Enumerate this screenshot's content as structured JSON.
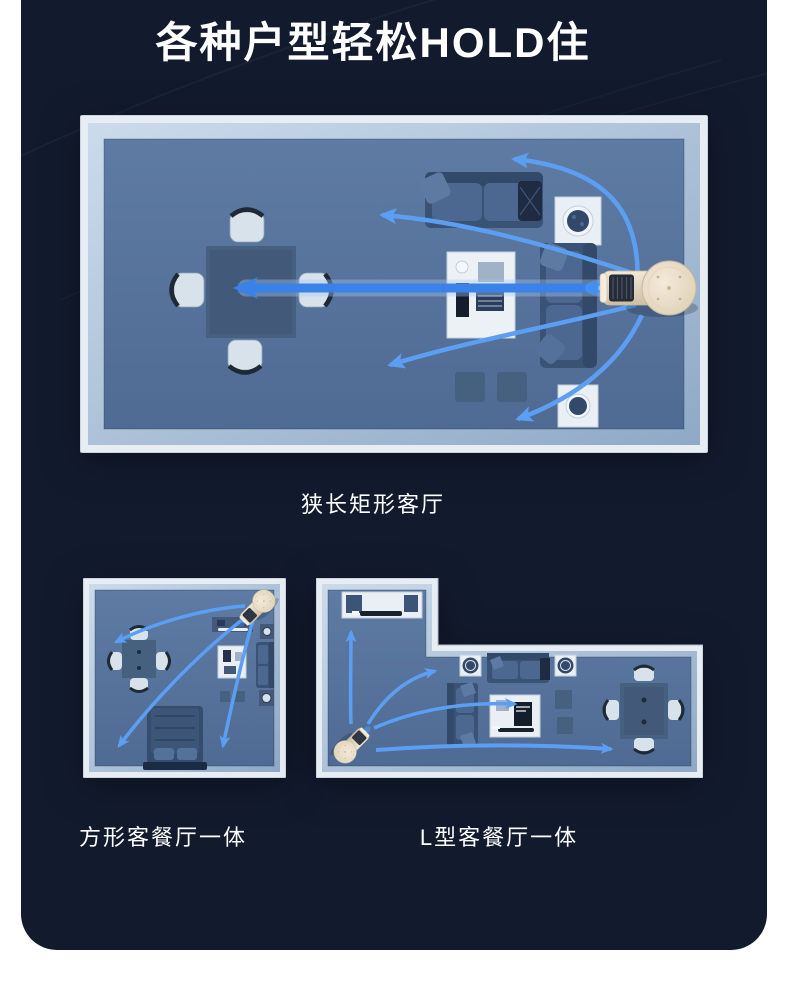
{
  "page": {
    "background": "#FFFFFF",
    "card_background": "#121B2E",
    "title": "各种户型轻松HOLD住",
    "title_color": "#FFFFFF"
  },
  "colors": {
    "wall": "#E7EDF3",
    "wall_bevel": "#AFC4DB",
    "floor": "#54719B",
    "furniture_dark": "#3A5274",
    "furniture_mid": "#46607F",
    "furniture_light": "#E9EFF5",
    "airflow_blue": "#3B82E8",
    "airflow_blue_light": "#5C9FF2",
    "fan_body": "#E9DCC6",
    "fan_grille": "#252C37"
  },
  "plans": {
    "large": {
      "caption": "狭长矩形客厅",
      "device": "air-circulator-fan",
      "airflow_arrow_count": 5
    },
    "square": {
      "caption": "方形客餐厅一体",
      "device": "air-circulator-fan",
      "airflow_arrow_count": 3
    },
    "lshape": {
      "caption": "L型客餐厅一体",
      "device": "air-circulator-fan",
      "airflow_arrow_count": 4
    }
  }
}
